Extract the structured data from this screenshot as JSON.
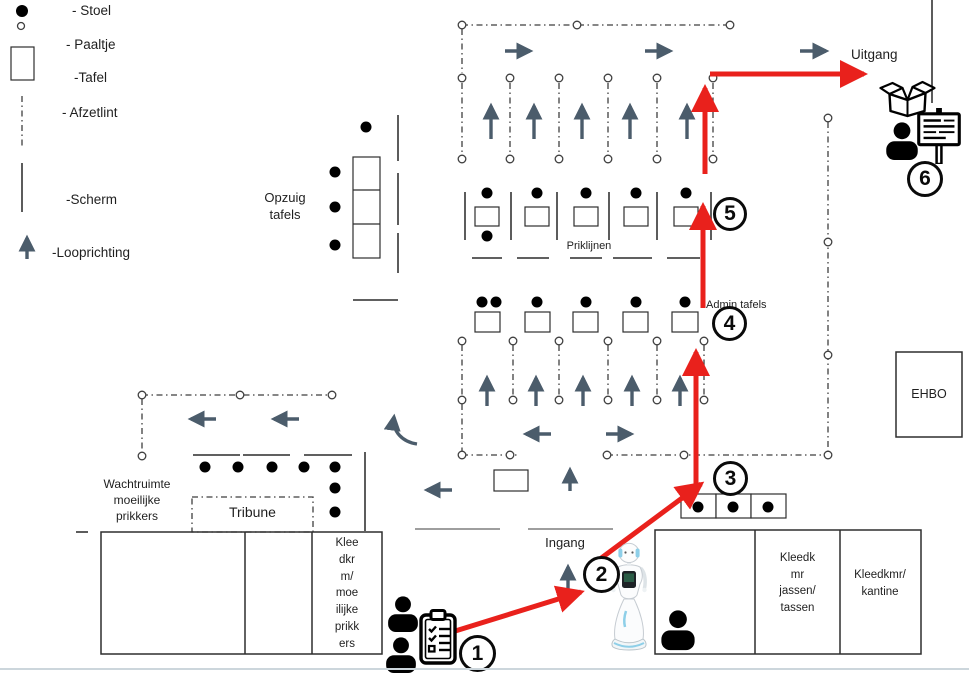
{
  "legend": {
    "items": [
      {
        "symbol": "chair-dot",
        "label": "- Stoel"
      },
      {
        "symbol": "post-circle",
        "label": "- Paaltje"
      },
      {
        "symbol": "table-rect",
        "label": "-Tafel"
      },
      {
        "symbol": "barrier-tape-line",
        "label": "- Afzetlint"
      },
      {
        "symbol": "screen-line",
        "label": "-Scherm"
      },
      {
        "symbol": "walking-direction-arrow",
        "label": "-Looprichting"
      }
    ]
  },
  "labels": {
    "uitgang": "Uitgang",
    "ingang": "Ingang",
    "priklijnen": "Priklijnen",
    "admin_tafels": "Admin tafels",
    "ehbo": "EHBO",
    "tribune": "Tribune",
    "opzuig_tafels": [
      "Opzuig",
      "tafels"
    ],
    "wachtruimte": [
      "Wachtruimte",
      "moeilijke",
      "prikkers"
    ],
    "kleedkamer_moeilijke_prikkers": [
      "Klee",
      "dkr",
      "m/",
      "moe",
      "ilijke",
      "prikk",
      "ers"
    ],
    "kleedkamer_jassen_tassen": [
      "Kleedk",
      "mr",
      "jassen/",
      "tassen"
    ],
    "kleedkamer_kantine": [
      "Kleedkmr/",
      "kantine"
    ]
  },
  "stations": [
    {
      "number": "1"
    },
    {
      "number": "2"
    },
    {
      "number": "3"
    },
    {
      "number": "4"
    },
    {
      "number": "5"
    },
    {
      "number": "6"
    }
  ],
  "colors": {
    "route_arrow": "#e9211c",
    "walking_direction_arrow": "#4b5c6b",
    "linework": "#3f3f3f"
  }
}
